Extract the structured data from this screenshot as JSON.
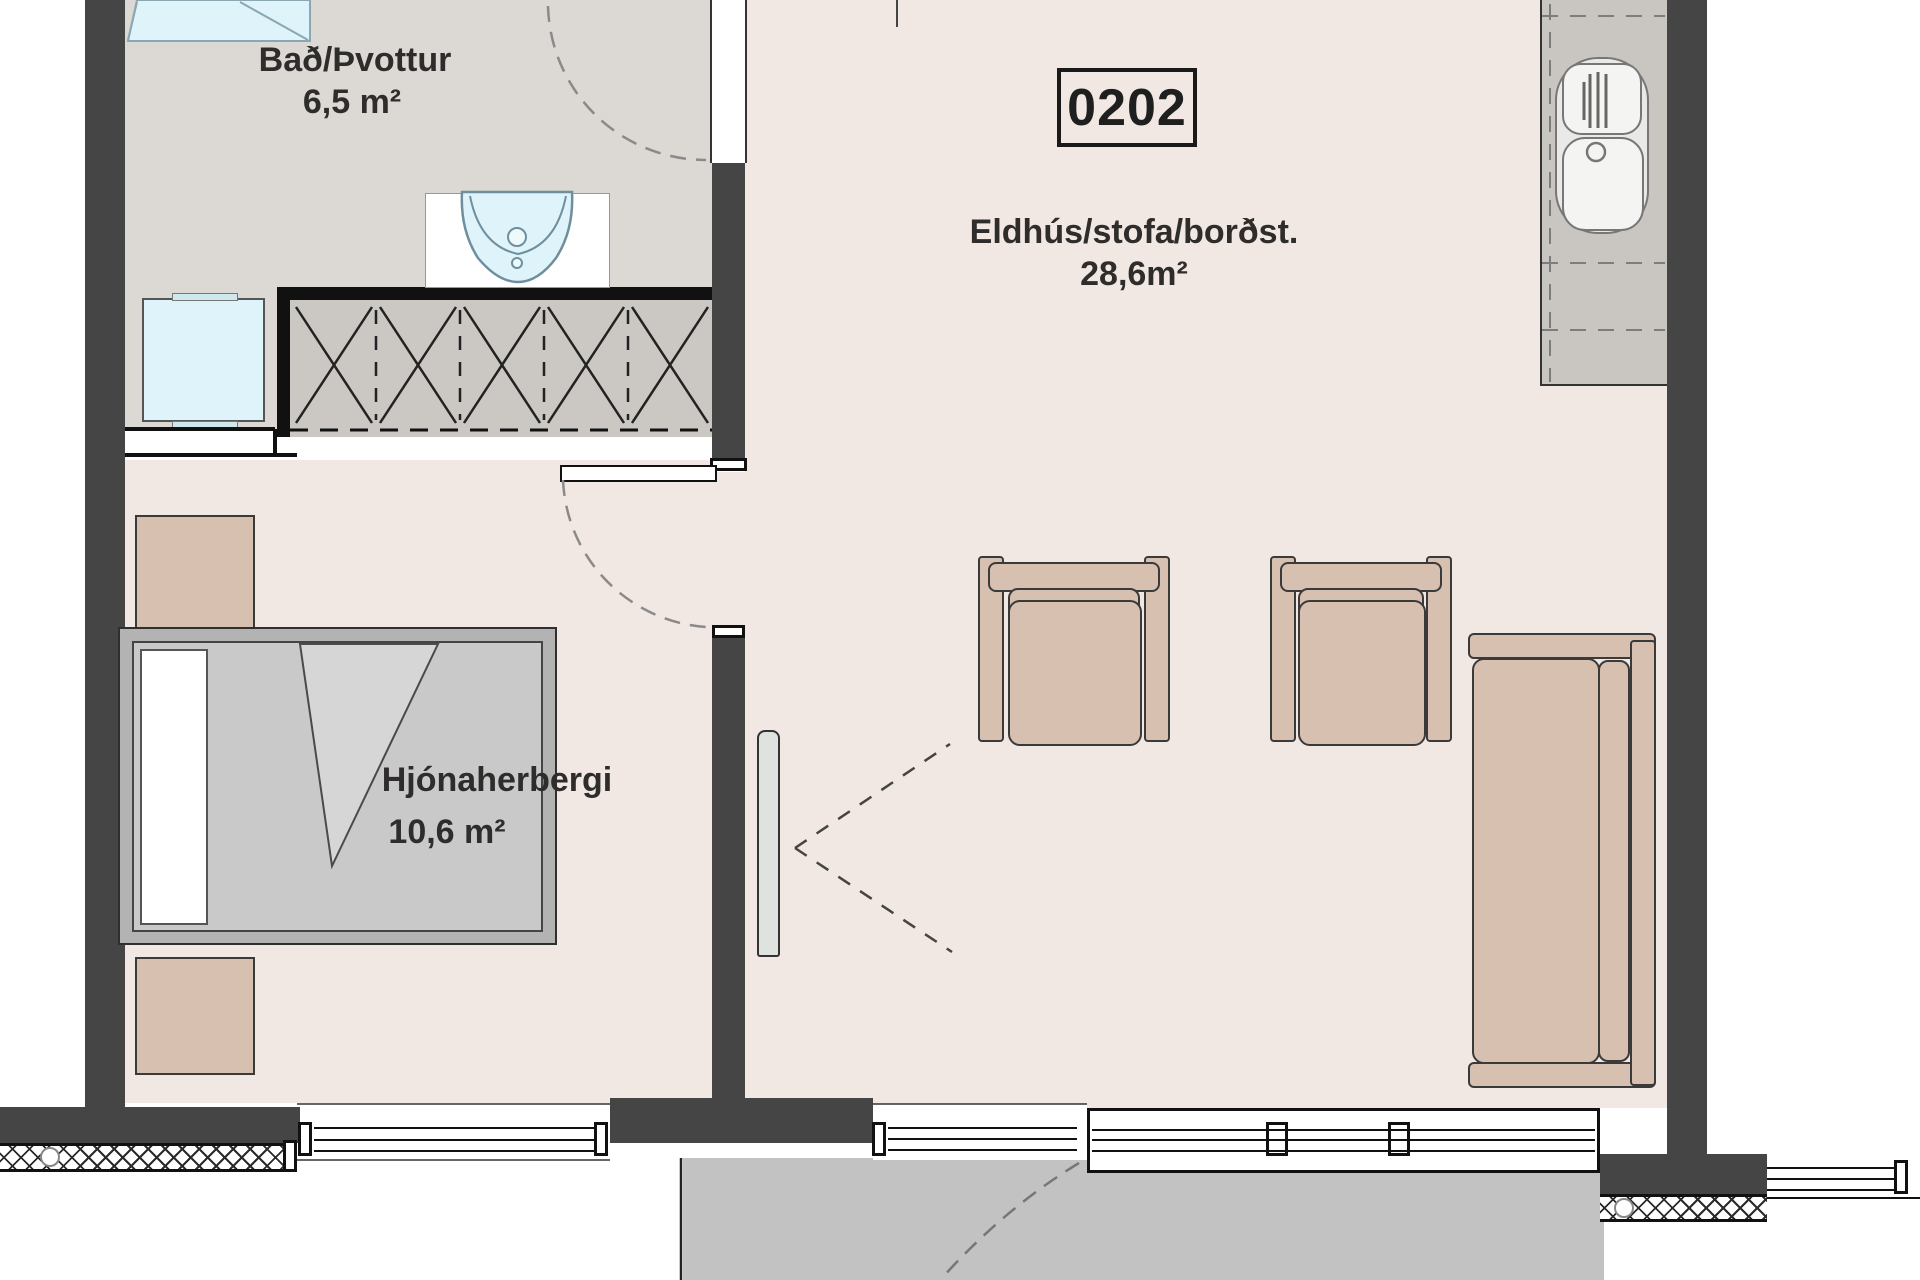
{
  "unit": {
    "number": "0202"
  },
  "rooms": {
    "bathroom": {
      "name": "Bað/Þvottur",
      "area": "6,5 m²"
    },
    "kitchen_living": {
      "name": "Eldhús/stofa/borðst.",
      "area": "28,6m²"
    },
    "bedroom": {
      "name": "Hjónaherbergi",
      "area": "10,6 m²"
    }
  },
  "furniture": {
    "bathroom": [
      "shower",
      "washing-machine",
      "washbasin"
    ],
    "bedroom": [
      "wardrobe",
      "bed",
      "nightstand",
      "nightstand"
    ],
    "kitchen_living": [
      "kitchen-counter",
      "kitchen-sink",
      "armchair",
      "armchair",
      "sofa",
      "open-door-leaf"
    ],
    "outside": [
      "balcony"
    ]
  },
  "colors": {
    "wall": "#454545",
    "floor_main": "#f1e7e3",
    "floor_bathroom": "#dcd8d4",
    "balcony": "#c2c2c2",
    "fixture_blue": "#dff4fa",
    "furniture_tan": "#d8c0b1",
    "counter_gray": "#c9c6c2",
    "line": "#1a1a1a"
  }
}
